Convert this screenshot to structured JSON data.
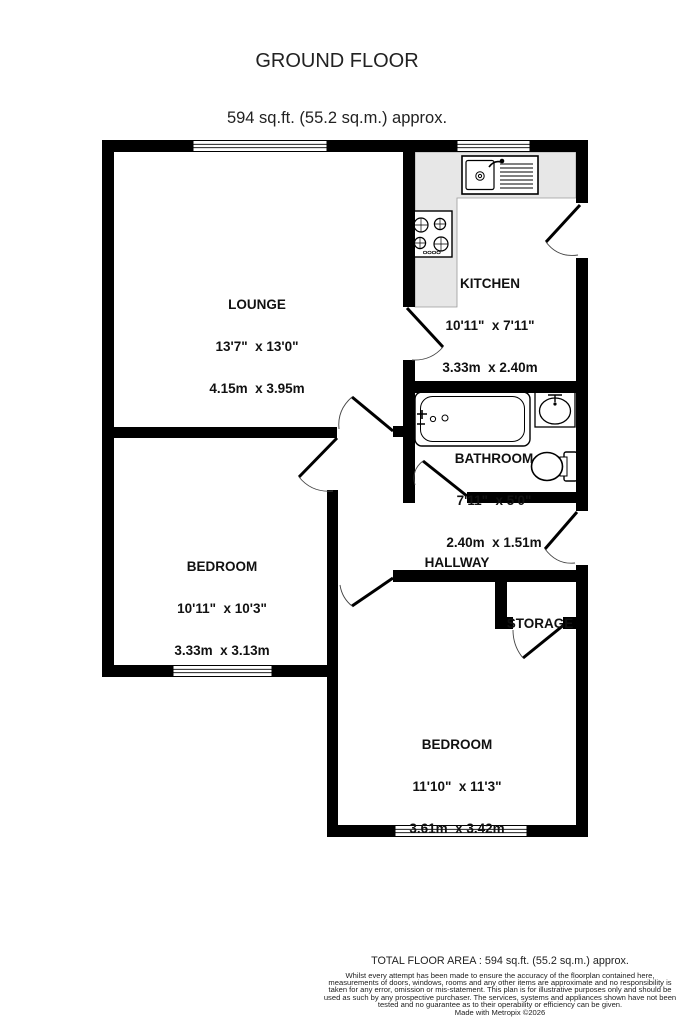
{
  "header": {
    "title": "GROUND FLOOR",
    "subtitle": "594 sq.ft. (55.2 sq.m.) approx."
  },
  "rooms": {
    "lounge": {
      "name": "LOUNGE",
      "imperial": "13'7\"  x 13'0\"",
      "metric": "4.15m  x 3.95m"
    },
    "kitchen": {
      "name": "KITCHEN",
      "imperial": "10'11\"  x 7'11\"",
      "metric": "3.33m  x 2.40m"
    },
    "bathroom": {
      "name": "BATHROOM",
      "imperial": "7'11\"  x 5'0\"",
      "metric": "2.40m  x 1.51m"
    },
    "bedroom1": {
      "name": "BEDROOM",
      "imperial": "10'11\"  x 10'3\"",
      "metric": "3.33m  x 3.13m"
    },
    "bedroom2": {
      "name": "BEDROOM",
      "imperial": "11'10\"  x 11'3\"",
      "metric": "3.61m  x 3.42m"
    },
    "hallway": {
      "name": "HALLWAY"
    },
    "storage": {
      "name": "STORAGE"
    }
  },
  "fixtures": [
    "kitchen-sink",
    "hob",
    "bathtub",
    "wash-basin",
    "toilet"
  ],
  "colors": {
    "wall": "#000000",
    "counter": "#e7e7e7",
    "background": "#ffffff"
  },
  "footer": {
    "total_area": "TOTAL FLOOR AREA : 594 sq.ft. (55.2 sq.m.) approx.",
    "disclaimer": "Whilst every attempt has been made to ensure the accuracy of the floorplan contained here, measurements of doors, windows, rooms and any other items are approximate and no responsibility is taken for any error, omission or mis-statement. This plan is for illustrative purposes only and should be used as such by any prospective purchaser. The services, systems and appliances shown have not been tested and no guarantee as to their operability or efficiency can be given.",
    "credit": "Made with Metropix ©2026"
  }
}
